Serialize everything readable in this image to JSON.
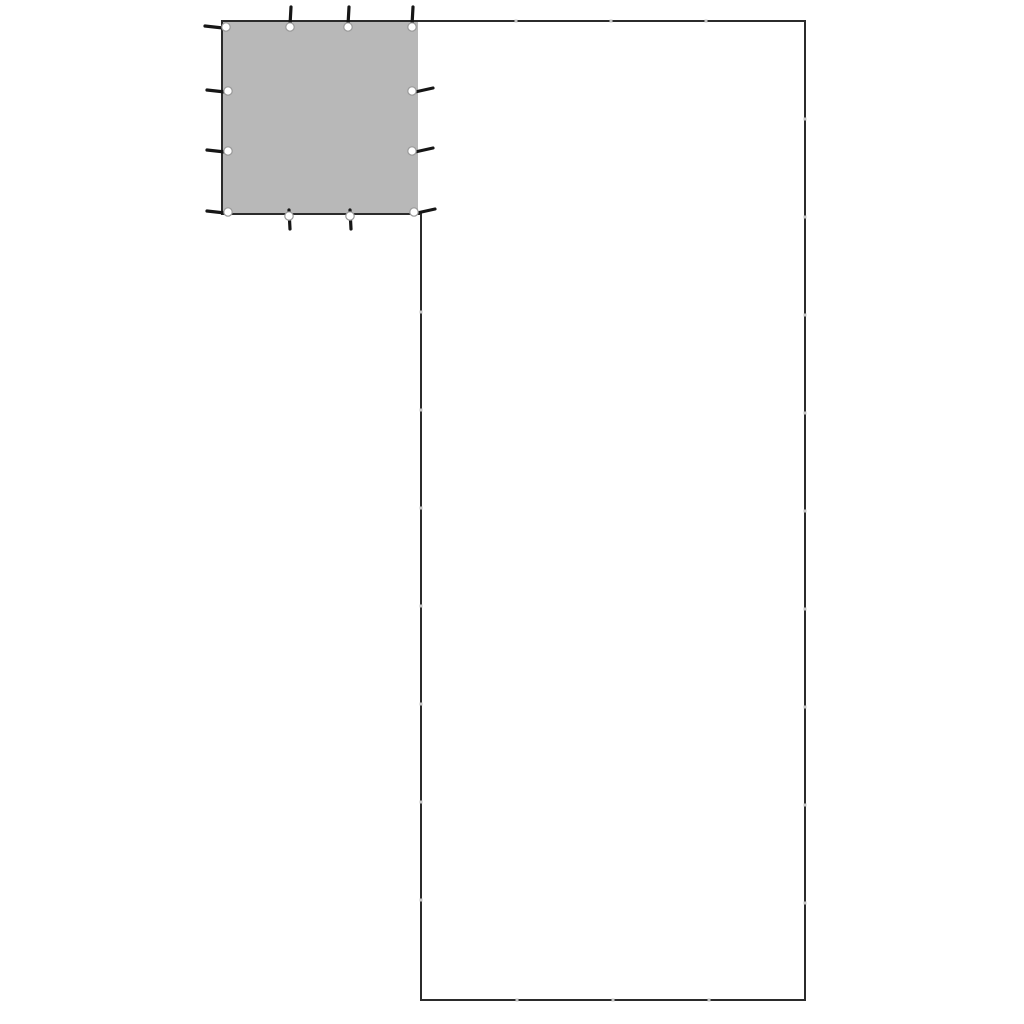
{
  "canvas": {
    "width": 1024,
    "height": 1024,
    "background_color": "#ffffff"
  },
  "diagram": {
    "description": "L-shaped plot outline with a gray tarp panel with eyelets placed in the top-left corner",
    "outline": {
      "stroke_color": "#2b2b2b",
      "stroke_width": 2,
      "points": [
        [
          222,
          21
        ],
        [
          805,
          21
        ],
        [
          805,
          1000
        ],
        [
          421,
          1000
        ],
        [
          421,
          214
        ],
        [
          222,
          214
        ]
      ]
    },
    "tarp_panel": {
      "fill_color": "#b8b8b8",
      "x": 222,
      "y": 21,
      "width": 196,
      "height": 193
    },
    "eyelets": {
      "hole_fill": "#ffffff",
      "hole_ring_color": "#9a9a9a",
      "hook_color": "#161616",
      "hook_width": 3.2,
      "hole_radius": 4.2,
      "items": [
        {
          "x": 226,
          "y": 27,
          "dir": "left"
        },
        {
          "x": 290,
          "y": 27,
          "dir": "up"
        },
        {
          "x": 348,
          "y": 27,
          "dir": "up"
        },
        {
          "x": 412,
          "y": 27,
          "dir": "up"
        },
        {
          "x": 228,
          "y": 91,
          "dir": "left"
        },
        {
          "x": 228,
          "y": 151,
          "dir": "left"
        },
        {
          "x": 228,
          "y": 212,
          "dir": "left"
        },
        {
          "x": 412,
          "y": 91,
          "dir": "right"
        },
        {
          "x": 412,
          "y": 151,
          "dir": "right"
        },
        {
          "x": 414,
          "y": 212,
          "dir": "right"
        },
        {
          "x": 289,
          "y": 216,
          "dir": "down"
        },
        {
          "x": 350,
          "y": 216,
          "dir": "down"
        }
      ]
    },
    "joint_marks": {
      "color": "#c6c6c6",
      "size": 3,
      "items": [
        {
          "x": 516,
          "y": 21
        },
        {
          "x": 611,
          "y": 21
        },
        {
          "x": 706,
          "y": 21
        },
        {
          "x": 805,
          "y": 119
        },
        {
          "x": 805,
          "y": 217
        },
        {
          "x": 805,
          "y": 315
        },
        {
          "x": 805,
          "y": 413
        },
        {
          "x": 805,
          "y": 511
        },
        {
          "x": 805,
          "y": 609
        },
        {
          "x": 805,
          "y": 707
        },
        {
          "x": 805,
          "y": 805
        },
        {
          "x": 805,
          "y": 903
        },
        {
          "x": 517,
          "y": 1000
        },
        {
          "x": 613,
          "y": 1000
        },
        {
          "x": 709,
          "y": 1000
        },
        {
          "x": 421,
          "y": 312
        },
        {
          "x": 421,
          "y": 410
        },
        {
          "x": 421,
          "y": 508
        },
        {
          "x": 421,
          "y": 606
        },
        {
          "x": 421,
          "y": 704
        },
        {
          "x": 421,
          "y": 802
        },
        {
          "x": 421,
          "y": 900
        }
      ]
    }
  }
}
